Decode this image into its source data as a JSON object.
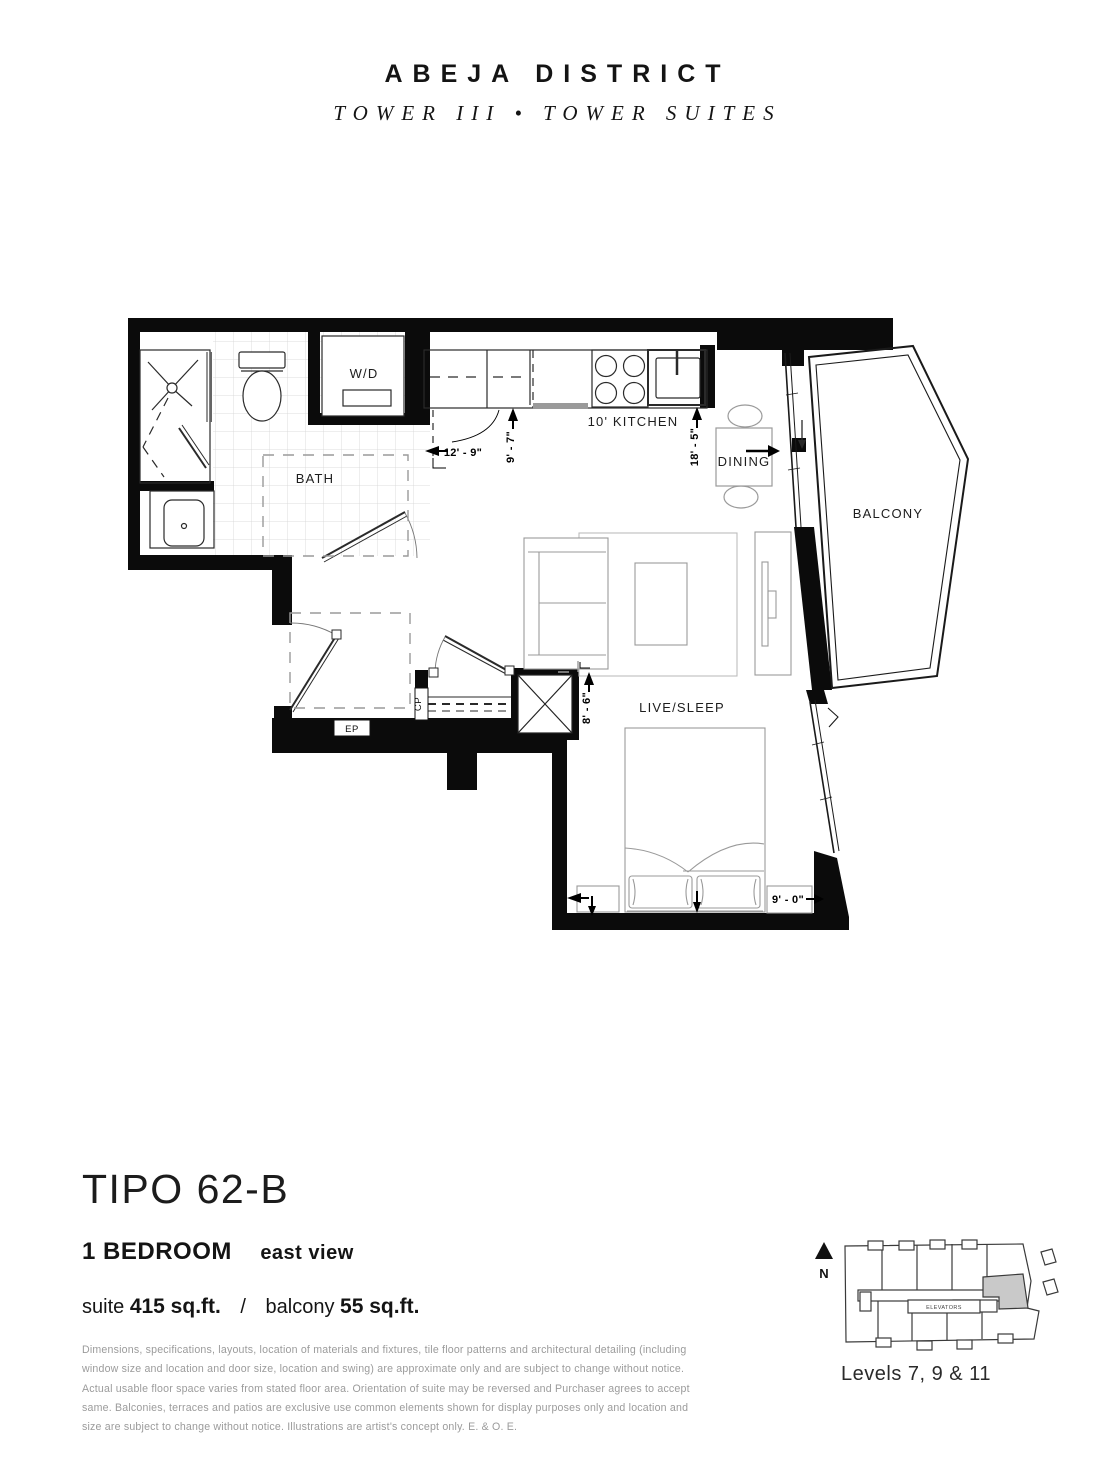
{
  "header": {
    "brand": "ABEJA DISTRICT",
    "subtitle": "TOWER III • TOWER SUITES"
  },
  "plan": {
    "rooms": {
      "bath": "BATH",
      "wd": "W/D",
      "kitchen": "10' KITCHEN",
      "dining": "DINING",
      "balcony": "BALCONY",
      "live_sleep": "LIVE/SLEEP"
    },
    "labels": {
      "ep": "EP",
      "cp": "CP"
    },
    "dimensions": {
      "hall_width": "12' - 9\"",
      "kitchen_depth": "9' - 7\"",
      "kitchen_length": "18' - 5\"",
      "live_width": "8' - 6\"",
      "bed_width": "9' - 0\""
    }
  },
  "suite": {
    "name": "TIPO 62-B",
    "type": "1 BEDROOM",
    "view": "east view",
    "suite_label": "suite",
    "suite_area": "415 sq.ft.",
    "separator": "/",
    "balcony_label": "balcony",
    "balcony_area": "55 sq.ft."
  },
  "disclaimer": "Dimensions, specifications, layouts, location of materials and fixtures, tile floor patterns and architectural detailing (including window size and location and door size, location and swing) are approximate only and are subject to change without notice. Actual usable floor space varies from stated floor area. Orientation of suite may be reversed and Purchaser agrees to accept same. Balconies, terraces and patios are exclusive use common elements shown for display purposes only and location and size are subject to change without notice. Illustrations are artist's concept only. E. & O. E.",
  "keyplan": {
    "north": "N",
    "levels": "Levels 7, 9 & 11",
    "elevators": "ELEVATORS"
  },
  "colors": {
    "ink": "#141414",
    "wall": "#0b0b0b",
    "furniture_gray": "#9a9a9a",
    "tile_gray": "#d4d4d4",
    "disclaimer_gray": "#9b9b9b",
    "shaded_unit": "#c9c9c9"
  }
}
